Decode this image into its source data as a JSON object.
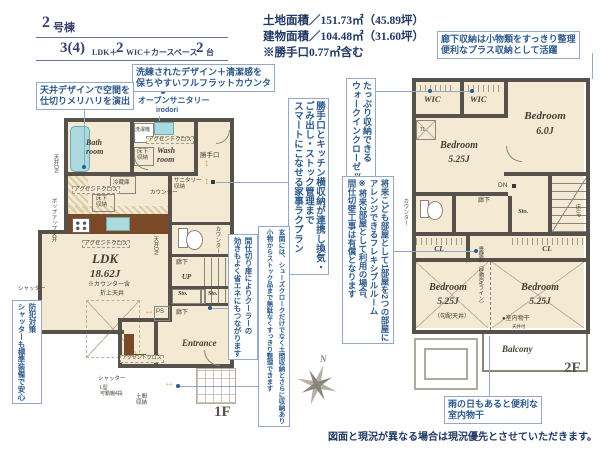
{
  "header": {
    "building_num": "2",
    "building_suffix": "号棟",
    "plan_seg1": "3(4)",
    "plan_seg2": "LDK＋",
    "plan_seg3": "2",
    "plan_seg4": "WIC＋カースペース",
    "plan_seg5": "2",
    "plan_seg6": "台"
  },
  "areas": {
    "land": "土地面積／151.73㎡（45.89坪）",
    "building": "建物面積／104.48㎡（31.60坪）",
    "note": "※勝手口0.77㎡含む"
  },
  "annotations": {
    "ceiling_design": "天井デザインで空間を\n仕切りメリハリを演出",
    "flat_counter": "洗練されたデザイン＋清潔感を\n保ちやすいフルフラットカウンタ",
    "open_sanitary": "オープンサニタリー",
    "open_sanitary_sub": "irodori",
    "hallway_storage": "廊下収納は小物類をすっきり整理\n便利なプラス収納として活躍",
    "wic": "たっぷり収納できる\nウォークインクローゼット",
    "kitchen_plan": "勝手口とキッチン横収納が連携し換気・\nごみ出し・ストック管理まで\nスマートにこなせる家事ラクプラン",
    "flexible_room": "将来こども部屋として1部屋を2つの部屋に\nアレンジできるフレキシブルルーム\n※将来2部屋として利用の場合、\n間仕切壁工事は有償となります",
    "entrance_storage": "玄関には、シューズクロークだけでなく土間収納とさらに収納あり\n小物からストック品まで無駄なくすっきり整理できます",
    "partition_door": "間仕切り扉によりクーラーの\n効きもよく省エネにもつながります",
    "security_shutter": "防犯対策\nシャッターも標準装備で安心",
    "indoor_drying": "雨の日もあると便利な\n室内物干"
  },
  "floor1": {
    "label": "1F",
    "bath": "Bath\nroom",
    "washer": "洗濯機",
    "accent_wash": "アクセントクロス",
    "underfloor_wash": "床下\n収納",
    "wash": "Wash\nroom",
    "sanitary_storage": "サニタリー\n収納",
    "backdoor": "勝手口",
    "fridge": "冷蔵庫",
    "counter_kitchen": "カウンター",
    "accent_kitchen": "アクセントクロス",
    "underfloor_kitchen": "床下\n収納",
    "ceiling_dn_left": "天井DN",
    "popup_ceiling": "ポップアップ天井",
    "ceiling_dn_right": "天井DN",
    "ldk": "LDK",
    "ldk_size": "18.62J",
    "ldk_note": "※カウンター含",
    "coffered": "折上天井",
    "accent_ldk": "アクセントクロス",
    "shutter_w": "シャッター",
    "hallway_up": "廊下",
    "up": "UP",
    "sto1": "Sto.",
    "sto2": "Sto.",
    "ps": "PS",
    "counter_wc": "カウンター",
    "hallway_s": "廊下",
    "entrance": "Entrance",
    "accent_entrance": "アクセントクロス",
    "shutter_s": "シャッター",
    "l_shelf": "L型\n可動棚4段",
    "doma": "土間\n収納"
  },
  "floor2": {
    "label": "2F",
    "wic1": "WIC",
    "wic2": "WIC",
    "tl": "TL",
    "bed1": "Bedroom",
    "bed1_size": "6.0J",
    "bed2": "Bedroom",
    "bed2_size": "5.25J",
    "counter_wc": "カウンター",
    "hallway": "廊下",
    "dn": "DN",
    "sto": "Sto.",
    "floor_up": "床UP",
    "cl1": "CL",
    "cl2": "CL",
    "bed3": "Bedroom",
    "bed3_size": "5.25J",
    "bed4": "Bedroom",
    "bed4_size": "5.25J",
    "slope_ceiling": "（勾配天井）",
    "wall_line": "垂壁無（壁想定ライン）",
    "drying": "●室内物干",
    "drying_sub": "天井付",
    "balcony": "Balcony"
  },
  "compass": {
    "n": "N"
  },
  "footer": "図面と現況が異なる場合は現況優先とさせていただきます。"
}
